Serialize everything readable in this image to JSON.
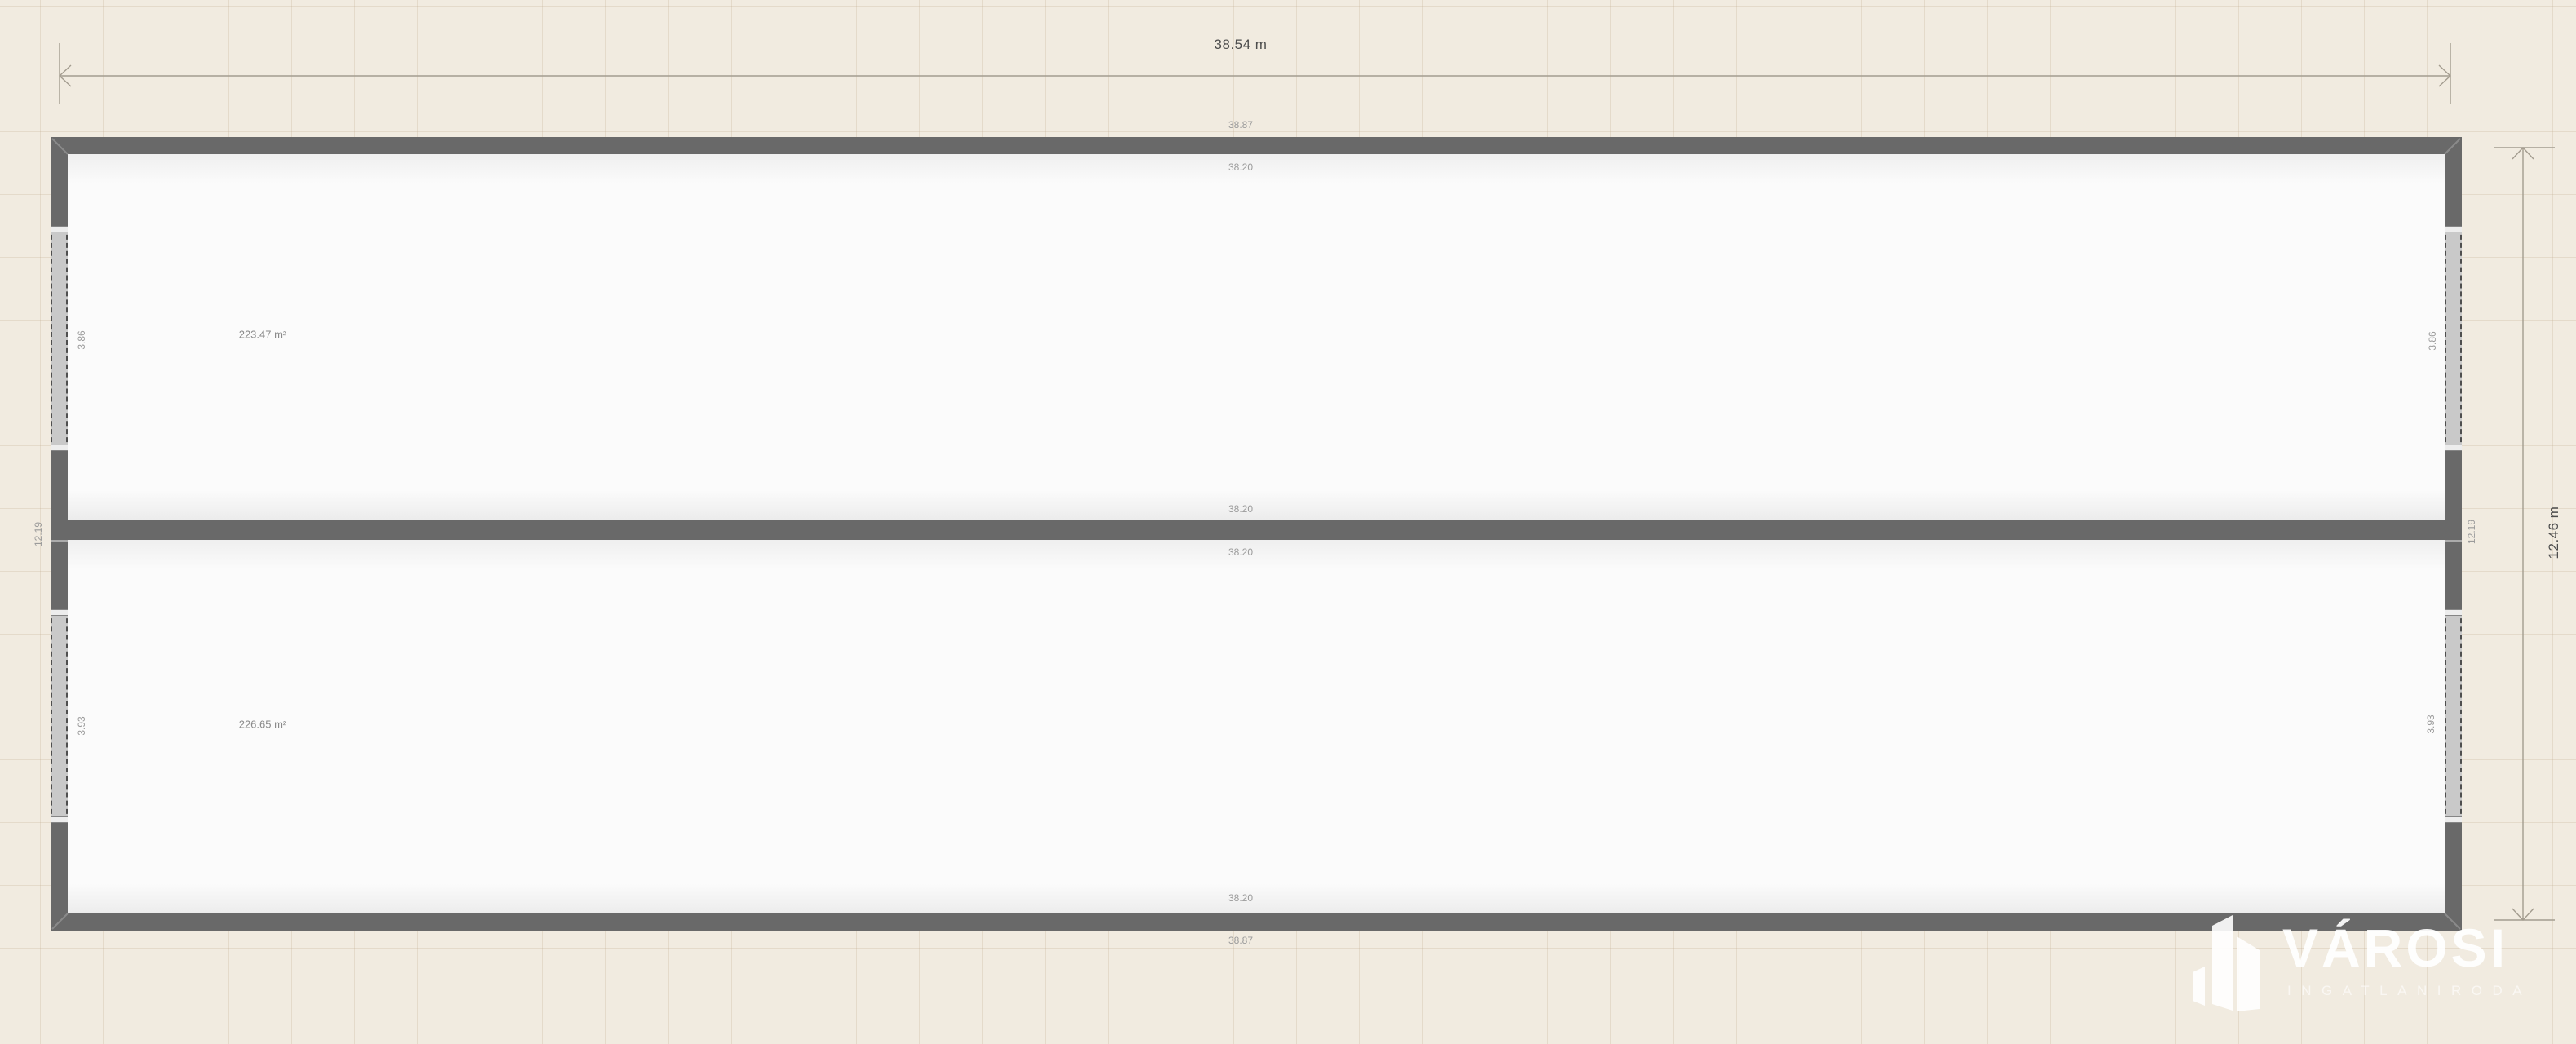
{
  "dimensions": {
    "overall_width": "38.54 m",
    "overall_height": "12.46 m"
  },
  "wall_labels": {
    "top_outer": "38.87",
    "top_inner": "38.20",
    "divider_upper": "38.20",
    "divider_lower": "38.20",
    "bottom_inner": "38.20",
    "bottom_outer": "38.87",
    "left_inner": "12.19",
    "right_inner": "12.19"
  },
  "openings": {
    "upper_left": "3.86",
    "upper_right": "3.86",
    "lower_left": "3.93",
    "lower_right": "3.93"
  },
  "rooms": [
    {
      "area": "223.47 m²"
    },
    {
      "area": "226.65 m²"
    }
  ],
  "watermark": {
    "brand": "VÁROSI",
    "subtitle": "INGATLANIRODA"
  },
  "colors": {
    "background": "#f1ebe0",
    "grid": "#e2d9c9",
    "wall": "#696969",
    "room": "#fbfbfb",
    "opening_fill": "#c9c9c9",
    "dimension_line": "#a39c8f",
    "label_small": "#9b9b9b",
    "label_strong": "#4d4d4d",
    "watermark": "#ffffff"
  }
}
